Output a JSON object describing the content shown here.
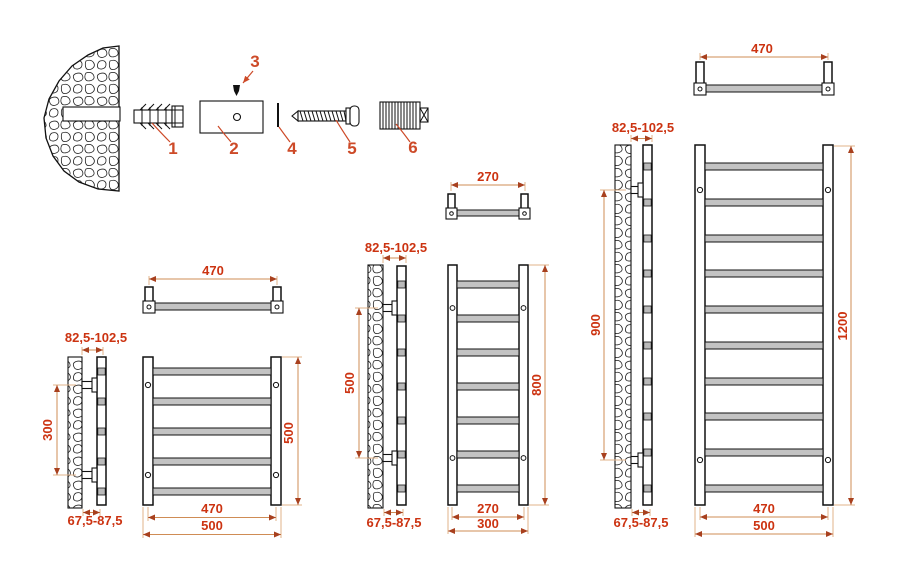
{
  "colors": {
    "dimension_text": "#cc3311",
    "dimension_line": "#cf8c55",
    "extension_line": "#e2b388",
    "arrow": "#a8401e",
    "rung_fill": "#c3c3c3",
    "outline": "#111111",
    "background": "#ffffff"
  },
  "hardware": {
    "part1": "1",
    "part2": "2",
    "part3": "3",
    "part4": "4",
    "part5": "5",
    "part6": "6"
  },
  "views": {
    "small": {
      "top_width": "470",
      "wall_offset_top": "82,5-102,5",
      "bracket_spacing": "300",
      "wall_offset_bottom": "67,5-87,5",
      "height": "500",
      "rail_width": "470",
      "overall_width": "500",
      "rung_count": 5
    },
    "medium": {
      "top_width": "270",
      "wall_offset_top": "82,5-102,5",
      "bracket_spacing": "500",
      "wall_offset_bottom": "67,5-87,5",
      "height": "800",
      "rail_width": "270",
      "overall_width": "300",
      "rung_count": 7
    },
    "large": {
      "top_width": "470",
      "wall_offset_top": "82,5-102,5",
      "bracket_spacing": "900",
      "wall_offset_bottom": "67,5-87,5",
      "height": "1200",
      "rail_width": "470",
      "overall_width": "500",
      "rung_count": 10
    }
  }
}
